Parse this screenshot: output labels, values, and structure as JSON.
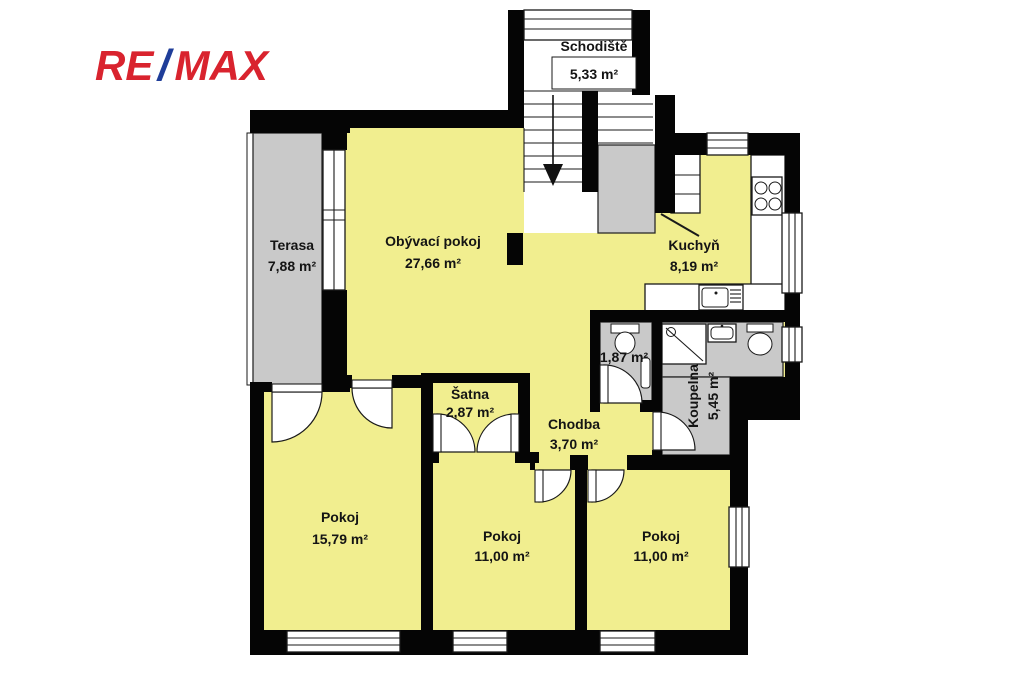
{
  "logo": {
    "re": "RE",
    "slash": "/",
    "max": "MAX"
  },
  "colors": {
    "floor_fill": "#F1EE8F",
    "outdoor_fill": "#C9C9C9",
    "wall": "#050505",
    "logo_red": "#D9232E",
    "logo_blue": "#1F3D99"
  },
  "rooms": {
    "schodiste": {
      "name": "Schodiště",
      "area": "5,33 m²"
    },
    "terasa": {
      "name": "Terasa",
      "area": "7,88 m²"
    },
    "obyvaci_pokoj": {
      "name": "Obývací pokoj",
      "area": "27,66 m²"
    },
    "kuchyn": {
      "name": "Kuchyň",
      "area": "8,19 m²"
    },
    "wc": {
      "area": "1,87 m²"
    },
    "koupelna": {
      "name": "Koupelna",
      "area": "5,45 m²"
    },
    "satna": {
      "name": "Šatna",
      "area": "2,87 m²"
    },
    "chodba": {
      "name": "Chodba",
      "area": "3,70 m²"
    },
    "pokoj_1": {
      "name": "Pokoj",
      "area": "15,79 m²"
    },
    "pokoj_2": {
      "name": "Pokoj",
      "area": "11,00 m²"
    },
    "pokoj_3": {
      "name": "Pokoj",
      "area": "11,00 m²"
    }
  }
}
